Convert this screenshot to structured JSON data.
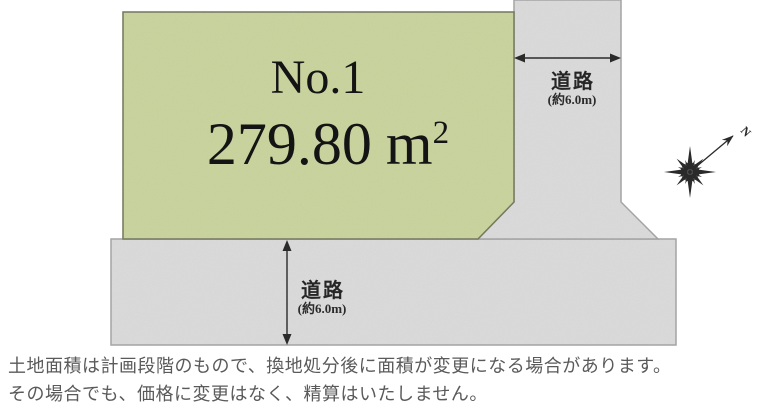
{
  "plot": {
    "number": "No.1",
    "area_value": "279.80",
    "area_unit": "m",
    "area_exponent": "2"
  },
  "road_right": {
    "label": "道路",
    "width_note": "(約6.0m)"
  },
  "road_bottom": {
    "label": "道路",
    "width_note": "(約6.0m)"
  },
  "compass": {
    "north_label": "N"
  },
  "disclaimer": {
    "line1": "土地面積は計画段階のもので、換地処分後に面積が変更になる場合があります。",
    "line2": "その場合でも、価格に変更はなく、精算はいたしません。"
  },
  "colors": {
    "plot_fill": "#c8d39c",
    "plot_border": "#72755c",
    "road_fill": "#dadada",
    "road_border": "#a3a3a3",
    "arrow_ink": "#2b2b2b",
    "disclaimer_text": "#5a5a5a"
  }
}
